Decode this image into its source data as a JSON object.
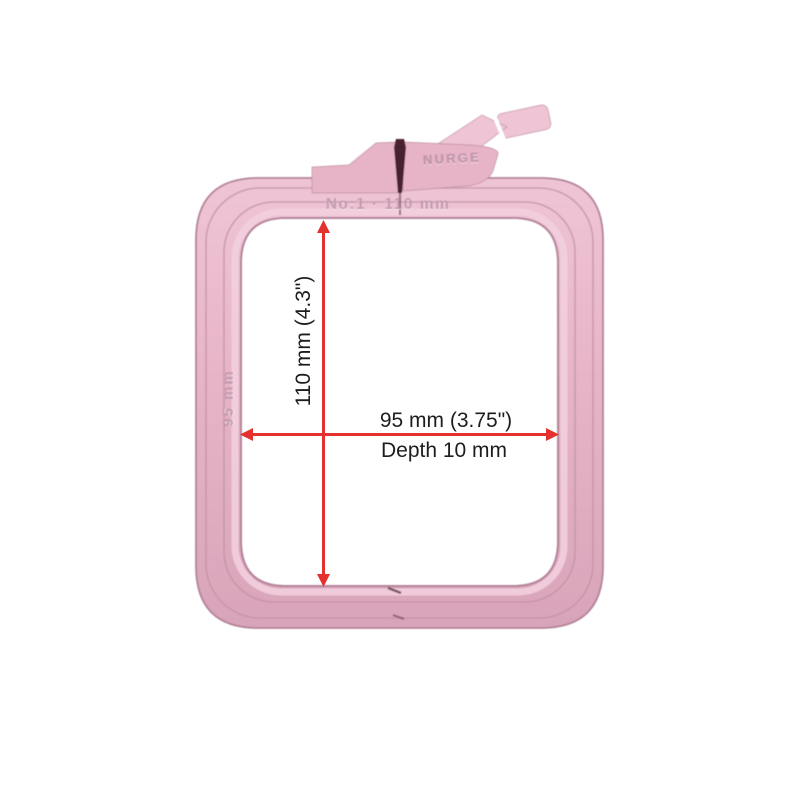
{
  "dimensions": {
    "height_label": "110 mm (4.3\")",
    "width_label": "95 mm (3.75\")",
    "depth_label": "Depth 10 mm",
    "height_mm": 110,
    "width_mm": 95,
    "depth_mm": 10
  },
  "product_markings": {
    "top_size_label": "No:1 · 110 mm",
    "side_size_label": "95 mm",
    "brand_label": "NURGE"
  },
  "colors": {
    "dimension_line": "#e5312d",
    "label_text": "#1d1d20",
    "hoop_base": "#e7b4c7",
    "hoop_light": "#efc5d5",
    "hoop_dark": "#d8a4b9",
    "hoop_edge": "#b4839a",
    "hoop_groove": "#c392a8",
    "hoop_band": "#f2cfde",
    "embossed_text": "#c096ab",
    "slot_dark": "#46242f",
    "background": "#ffffff"
  }
}
